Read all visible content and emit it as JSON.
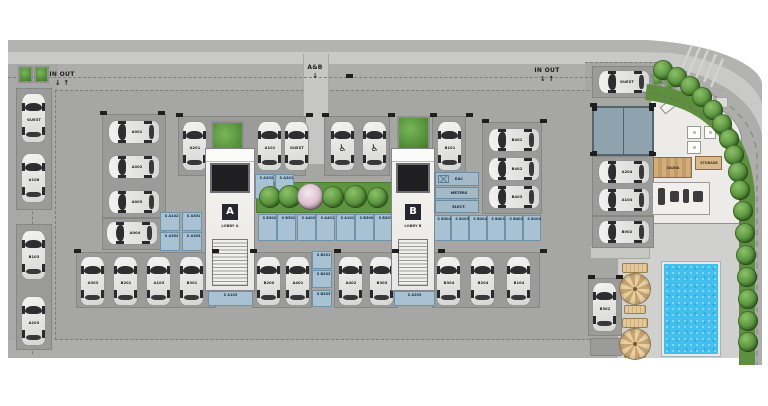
{
  "plan": {
    "colors": {
      "paper": "#ffffff",
      "slab": "#a6a6a4",
      "road": "#adadab",
      "sidewalk": "#c9c9c7",
      "pad": "#9b9b99",
      "deck": "#d0d0ce",
      "storage_fill": "#a9c2d3",
      "hedge": "#5d8f3f",
      "pool_water": "#41bfee",
      "canopy": "#8ea3ad"
    },
    "glyphs": {
      "handicap": "♿",
      "down": "↓",
      "up": "↑"
    },
    "signs": [
      {
        "n": "entrance-left",
        "t": "IN OUT",
        "a": "↓ ↑",
        "x": 44,
        "y": 71,
        "w": 36
      },
      {
        "n": "entrance-right",
        "t": "IN OUT",
        "a": "↓ ↑",
        "x": 529,
        "y": 67,
        "w": 36
      },
      {
        "n": "entrance-lobbies",
        "t": "A&B",
        "a": "↓",
        "x": 300,
        "y": 64,
        "w": 30
      }
    ],
    "zones": [
      {
        "n": "top-outer-band",
        "x": 8,
        "y": 40,
        "w": 632,
        "h": 12,
        "f": "#b3b3b1"
      },
      {
        "n": "top-sidewalk",
        "x": 8,
        "y": 52,
        "w": 632,
        "h": 12,
        "f": "#c9c9c7",
        "cls": "joints"
      },
      {
        "n": "top-road",
        "x": 8,
        "y": 64,
        "w": 632,
        "h": 26,
        "f": "#adadab"
      },
      {
        "n": "left-road",
        "x": 8,
        "y": 64,
        "w": 50,
        "h": 294,
        "f": "#a8a8a6"
      },
      {
        "n": "guest-bay-apron",
        "x": 585,
        "y": 62,
        "w": 72,
        "h": 30,
        "f": "#a6a6a4"
      },
      {
        "n": "main-parking-slab",
        "x": 55,
        "y": 90,
        "w": 600,
        "h": 250,
        "f": "#a6a6a4",
        "cls": "dashed"
      },
      {
        "n": "bottom-apron",
        "x": 8,
        "y": 340,
        "w": 650,
        "h": 18,
        "f": "#adadab"
      },
      {
        "n": "pool-deck",
        "x": 618,
        "y": 222,
        "w": 134,
        "h": 136,
        "f": "#d0d0ce",
        "cls": "joints2"
      },
      {
        "n": "amenity-floor",
        "x": 650,
        "y": 92,
        "w": 92,
        "h": 132,
        "f": "#edebe7",
        "cls": "amenity"
      },
      {
        "n": "lobby-walkway",
        "x": 303,
        "y": 54,
        "w": 26,
        "h": 110,
        "f": "#c6c6c4",
        "cls": "hatchh"
      },
      {
        "n": "pool-steps",
        "x": 590,
        "y": 246,
        "w": 60,
        "h": 13,
        "f": "#c6c6c4",
        "cls": "hatchv"
      }
    ],
    "dashes": [
      {
        "n": "road-centerline-top",
        "x": 8,
        "y": 77,
        "w": 630
      },
      {
        "n": "lane-centerline-left",
        "x": 32,
        "y": 92,
        "h": 262,
        "v": true
      },
      {
        "n": "guest-bay-line",
        "x": 585,
        "y": 62,
        "w": 72
      }
    ],
    "pads": [
      {
        "x": 16,
        "y": 88,
        "w": 36,
        "h": 122
      },
      {
        "x": 16,
        "y": 224,
        "w": 36,
        "h": 126
      },
      {
        "x": 102,
        "y": 114,
        "w": 64,
        "h": 104
      },
      {
        "x": 102,
        "y": 218,
        "w": 64,
        "h": 32
      },
      {
        "x": 178,
        "y": 116,
        "w": 128,
        "h": 60
      },
      {
        "x": 324,
        "y": 116,
        "w": 66,
        "h": 60
      },
      {
        "x": 432,
        "y": 116,
        "w": 34,
        "h": 60
      },
      {
        "x": 482,
        "y": 122,
        "w": 60,
        "h": 92
      },
      {
        "x": 76,
        "y": 252,
        "w": 140,
        "h": 56
      },
      {
        "x": 252,
        "y": 252,
        "w": 60,
        "h": 56
      },
      {
        "x": 334,
        "y": 252,
        "w": 64,
        "h": 56
      },
      {
        "x": 432,
        "y": 252,
        "w": 108,
        "h": 56
      },
      {
        "x": 592,
        "y": 66,
        "w": 62,
        "h": 32
      },
      {
        "x": 592,
        "y": 156,
        "w": 62,
        "h": 60
      },
      {
        "x": 592,
        "y": 216,
        "w": 62,
        "h": 32
      },
      {
        "x": 588,
        "y": 278,
        "w": 34,
        "h": 58
      },
      {
        "x": 590,
        "y": 338,
        "w": 32,
        "h": 18
      }
    ],
    "marks": [
      [
        100,
        111
      ],
      [
        158,
        111
      ],
      [
        176,
        113
      ],
      [
        306,
        113
      ],
      [
        322,
        113
      ],
      [
        388,
        113
      ],
      [
        430,
        113
      ],
      [
        466,
        113
      ],
      [
        482,
        119
      ],
      [
        540,
        119
      ],
      [
        74,
        249
      ],
      [
        212,
        249
      ],
      [
        250,
        249
      ],
      [
        334,
        249
      ],
      [
        392,
        249
      ],
      [
        438,
        249
      ],
      [
        540,
        249
      ],
      [
        588,
        275
      ],
      [
        616,
        275
      ],
      [
        590,
        103
      ],
      [
        649,
        103
      ],
      [
        590,
        152
      ],
      [
        649,
        152
      ],
      [
        346,
        74
      ]
    ],
    "planters": [
      {
        "x": 18,
        "y": 66,
        "w": 15,
        "h": 17
      },
      {
        "x": 34,
        "y": 66,
        "w": 15,
        "h": 17
      },
      {
        "x": 211,
        "y": 121,
        "w": 33,
        "h": 37
      },
      {
        "x": 397,
        "y": 116,
        "w": 33,
        "h": 36
      },
      {
        "x": 651,
        "y": 72,
        "w": 12,
        "h": 14,
        "r": -14
      },
      {
        "x": 664,
        "y": 76,
        "w": 12,
        "h": 14,
        "r": -22
      }
    ],
    "garden": {
      "box": {
        "x": 256,
        "y": 182,
        "w": 136,
        "h": 31
      },
      "trees": [
        {
          "x": 270,
          "y": 197,
          "dm": 22
        },
        {
          "x": 289,
          "y": 196,
          "dm": 23
        },
        {
          "x": 310,
          "y": 196,
          "dm": 27,
          "fl": true
        },
        {
          "x": 333,
          "y": 197,
          "dm": 22
        },
        {
          "x": 355,
          "y": 196,
          "dm": 23
        },
        {
          "x": 377,
          "y": 197,
          "dm": 21
        }
      ]
    },
    "curve_trees": [
      {
        "x": 663,
        "y": 70
      },
      {
        "x": 677,
        "y": 77
      },
      {
        "x": 690,
        "y": 86
      },
      {
        "x": 702,
        "y": 97
      },
      {
        "x": 713,
        "y": 110
      },
      {
        "x": 722,
        "y": 124
      },
      {
        "x": 729,
        "y": 139
      },
      {
        "x": 734,
        "y": 155
      },
      {
        "x": 738,
        "y": 172
      },
      {
        "x": 740,
        "y": 190
      },
      {
        "x": 743,
        "y": 211
      },
      {
        "x": 745,
        "y": 233
      },
      {
        "x": 746,
        "y": 255
      },
      {
        "x": 747,
        "y": 277
      },
      {
        "x": 748,
        "y": 299
      },
      {
        "x": 748,
        "y": 321
      },
      {
        "x": 748,
        "y": 342
      }
    ],
    "storages": [
      {
        "x": 255,
        "y": 174,
        "w": 19,
        "h": 25,
        "l": "S A202"
      },
      {
        "x": 275,
        "y": 174,
        "w": 19,
        "h": 25,
        "l": "S A201"
      },
      {
        "x": 160,
        "y": 212,
        "w": 20,
        "h": 19,
        "l": "S A102"
      },
      {
        "x": 182,
        "y": 212,
        "w": 20,
        "h": 19,
        "l": "S A301"
      },
      {
        "x": 160,
        "y": 232,
        "w": 20,
        "h": 19,
        "l": "S A302"
      },
      {
        "x": 182,
        "y": 232,
        "w": 20,
        "h": 19,
        "l": "S A303"
      },
      {
        "x": 208,
        "y": 291,
        "w": 45,
        "h": 15,
        "l": "S A103"
      },
      {
        "x": 258,
        "y": 214,
        "w": 19,
        "h": 27,
        "l": "S B302"
      },
      {
        "x": 277,
        "y": 214,
        "w": 19,
        "h": 27,
        "l": "S B301"
      },
      {
        "x": 297,
        "y": 214,
        "w": 19,
        "h": 27,
        "l": "S A402"
      },
      {
        "x": 316,
        "y": 214,
        "w": 19,
        "h": 27,
        "l": "S A401"
      },
      {
        "x": 336,
        "y": 214,
        "w": 19,
        "h": 27,
        "l": "S A101"
      },
      {
        "x": 355,
        "y": 214,
        "w": 19,
        "h": 27,
        "l": "S B300"
      },
      {
        "x": 374,
        "y": 214,
        "w": 19,
        "h": 27,
        "l": "S B303"
      },
      {
        "x": 312,
        "y": 251,
        "w": 20,
        "h": 18,
        "l": "S B201"
      },
      {
        "x": 312,
        "y": 270,
        "w": 20,
        "h": 18,
        "l": "S B202"
      },
      {
        "x": 312,
        "y": 290,
        "w": 20,
        "h": 17,
        "l": "S B203"
      },
      {
        "x": 394,
        "y": 291,
        "w": 41,
        "h": 15,
        "l": "S A203"
      },
      {
        "x": 433,
        "y": 215,
        "w": 18,
        "h": 26,
        "l": "S B304"
      },
      {
        "x": 451,
        "y": 215,
        "w": 18,
        "h": 26,
        "l": "S B103"
      },
      {
        "x": 469,
        "y": 215,
        "w": 18,
        "h": 26,
        "l": "S B204"
      },
      {
        "x": 487,
        "y": 215,
        "w": 18,
        "h": 26,
        "l": "S B401"
      },
      {
        "x": 505,
        "y": 215,
        "w": 18,
        "h": 26,
        "l": "S B402"
      },
      {
        "x": 523,
        "y": 215,
        "w": 18,
        "h": 26,
        "l": "S B104"
      }
    ],
    "rooms": [
      {
        "x": 435,
        "y": 172,
        "w": 44,
        "h": 14,
        "l": "EAC",
        "hatch": true
      },
      {
        "x": 435,
        "y": 187,
        "w": 44,
        "h": 12,
        "l": "METERS"
      },
      {
        "x": 435,
        "y": 200,
        "w": 44,
        "h": 13,
        "l": "ELECT."
      }
    ],
    "cores": [
      {
        "n": "tower-a-core",
        "x": 205,
        "y": 148,
        "w": 50,
        "h": 143,
        "letter": "A",
        "label": "LOBBY A"
      },
      {
        "n": "tower-b-core",
        "x": 391,
        "y": 148,
        "w": 44,
        "h": 143,
        "letter": "B",
        "label": "LOBBY B"
      }
    ],
    "cars": [
      {
        "x": 21,
        "y": 93,
        "d": "v",
        "l": "GUEST"
      },
      {
        "x": 21,
        "y": 153,
        "d": "v",
        "l": "A106"
      },
      {
        "x": 21,
        "y": 230,
        "d": "v",
        "l": "B103"
      },
      {
        "x": 21,
        "y": 296,
        "d": "v",
        "l": "A203"
      },
      {
        "x": 108,
        "y": 120,
        "d": "h",
        "l": "A001"
      },
      {
        "x": 108,
        "y": 155,
        "d": "h",
        "l": "A002"
      },
      {
        "x": 108,
        "y": 190,
        "d": "h",
        "l": "A003"
      },
      {
        "x": 106,
        "y": 221,
        "d": "h",
        "l": "A004"
      },
      {
        "x": 182,
        "y": 121,
        "d": "v",
        "l": "A201"
      },
      {
        "x": 257,
        "y": 121,
        "d": "v",
        "l": "A101"
      },
      {
        "x": 284,
        "y": 121,
        "d": "v",
        "l": "GUEST"
      },
      {
        "x": 330,
        "y": 121,
        "d": "v",
        "hc": true
      },
      {
        "x": 362,
        "y": 121,
        "d": "v",
        "hc": true
      },
      {
        "x": 437,
        "y": 121,
        "d": "v",
        "l": "B101"
      },
      {
        "x": 488,
        "y": 128,
        "d": "h",
        "l": "B401"
      },
      {
        "x": 488,
        "y": 157,
        "d": "h",
        "l": "B402"
      },
      {
        "x": 488,
        "y": 185,
        "d": "h",
        "l": "B403"
      },
      {
        "x": 80,
        "y": 256,
        "d": "v",
        "l": "A303"
      },
      {
        "x": 113,
        "y": 256,
        "d": "v",
        "l": "B201"
      },
      {
        "x": 146,
        "y": 256,
        "d": "v",
        "l": "A103"
      },
      {
        "x": 179,
        "y": 256,
        "d": "v",
        "l": "B301"
      },
      {
        "x": 256,
        "y": 256,
        "d": "v",
        "l": "B200"
      },
      {
        "x": 285,
        "y": 256,
        "d": "v",
        "l": "A401"
      },
      {
        "x": 338,
        "y": 256,
        "d": "v",
        "l": "A402"
      },
      {
        "x": 369,
        "y": 256,
        "d": "v",
        "l": "B303"
      },
      {
        "x": 436,
        "y": 256,
        "d": "v",
        "l": "B304"
      },
      {
        "x": 470,
        "y": 256,
        "d": "v",
        "l": "B204"
      },
      {
        "x": 506,
        "y": 256,
        "d": "v",
        "l": "B104"
      },
      {
        "x": 598,
        "y": 70,
        "d": "h",
        "l": "GUEST"
      },
      {
        "x": 598,
        "y": 160,
        "d": "h",
        "l": "A204"
      },
      {
        "x": 598,
        "y": 188,
        "d": "h",
        "l": "A104"
      },
      {
        "x": 598,
        "y": 220,
        "d": "h",
        "l": "B002"
      },
      {
        "x": 592,
        "y": 282,
        "d": "v",
        "l": "B302"
      }
    ],
    "amenity": {
      "desk": {
        "x": 660,
        "y": 99,
        "w": 24,
        "h": 9,
        "r": -38
      },
      "closets": [
        {
          "x": 694,
          "y": 95,
          "w": 20,
          "h": 12
        },
        {
          "x": 716,
          "y": 97,
          "w": 12,
          "h": 11
        }
      ],
      "fixtures": [
        {
          "x": 687,
          "y": 126,
          "w": 14,
          "h": 13
        },
        {
          "x": 687,
          "y": 141,
          "w": 14,
          "h": 13
        },
        {
          "x": 704,
          "y": 126,
          "w": 12,
          "h": 13
        }
      ],
      "sauna": {
        "x": 653,
        "y": 157,
        "w": 39,
        "h": 21,
        "l": "SAUNA"
      },
      "store": {
        "x": 695,
        "y": 156,
        "w": 27,
        "h": 14,
        "l": "STORAGE"
      },
      "gym": {
        "box": {
          "x": 652,
          "y": 182,
          "w": 58,
          "h": 33
        },
        "equip": [
          {
            "x": 6,
            "y": 6,
            "w": 7,
            "h": 17
          },
          {
            "x": 18,
            "y": 9,
            "w": 9,
            "h": 11
          },
          {
            "x": 31,
            "y": 7,
            "w": 6,
            "h": 14
          },
          {
            "x": 41,
            "y": 9,
            "w": 10,
            "h": 11
          }
        ]
      }
    },
    "poolarea": {
      "pool": {
        "x": 662,
        "y": 262,
        "w": 58,
        "h": 94
      },
      "umbrellas": [
        {
          "x": 620,
          "y": 274
        },
        {
          "x": 620,
          "y": 329
        }
      ],
      "loungers": [
        {
          "x": 622,
          "y": 263,
          "w": 26,
          "h": 10
        },
        {
          "x": 624,
          "y": 305,
          "w": 22,
          "h": 9
        },
        {
          "x": 622,
          "y": 318,
          "w": 26,
          "h": 10
        },
        {
          "x": 624,
          "y": 352,
          "w": 22,
          "h": 6
        }
      ]
    },
    "canopy": {
      "x": 592,
      "y": 106,
      "w": 62,
      "h": 50
    }
  }
}
